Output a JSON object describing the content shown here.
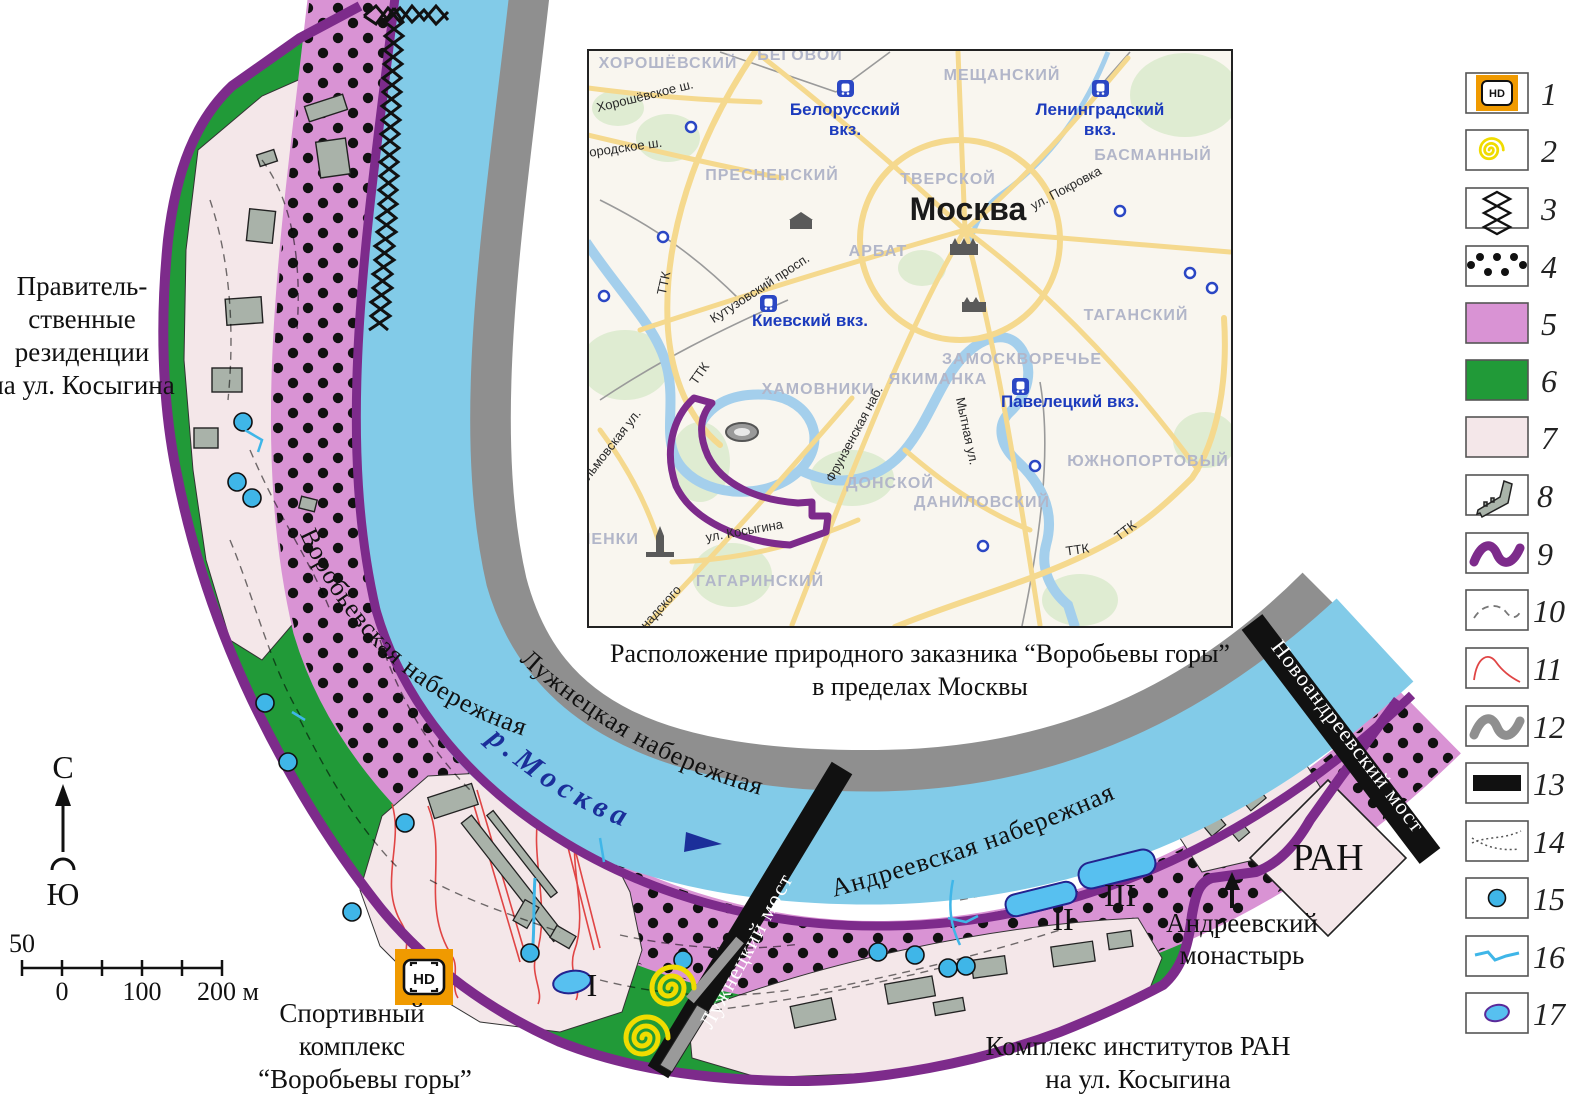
{
  "legend": {
    "numbers": [
      "1",
      "2",
      "3",
      "4",
      "5",
      "6",
      "7",
      "8",
      "9",
      "10",
      "11",
      "12",
      "13",
      "14",
      "15",
      "16",
      "17"
    ],
    "swatches": [
      "hd-marker",
      "spiral",
      "shore-zigzag",
      "dotted-zone",
      "pink-zone",
      "green-zone",
      "lightpink-zone",
      "building",
      "reserve-boundary",
      "dashed-path",
      "red-line",
      "gray-road",
      "bridge",
      "trail",
      "spring",
      "stream",
      "pond"
    ]
  },
  "compass": {
    "north": "С",
    "south": "Ю"
  },
  "scalebar": {
    "above": "50",
    "t0": "0",
    "t100": "100",
    "t200": "200 м"
  },
  "labels": {
    "gov1": "Правитель-",
    "gov2": "ственные",
    "gov3": "резиденции",
    "gov4": "на ул. Косыгина",
    "sport1": "Спортивный",
    "sport2": "комплекс",
    "sport3": "“Воробьевы горы”",
    "ranc1": "Комплекс институтов РАН",
    "ranc2": "на ул. Косыгина",
    "mon1": "Андреевский",
    "mon2": "монастырь",
    "ran": "РАН",
    "num1": "I",
    "num2": "II",
    "num3": "III",
    "hd": "HD",
    "emb_vorob": "Воробьевская набережная",
    "emb_luzh": "Лужнецкая набережная",
    "emb_andr": "Андреевская набережная",
    "river": "р.Москва",
    "bridge1": "Лужнецкий мост",
    "bridge2": "Новоандреевский мост"
  },
  "inset": {
    "caption1": "Расположение природного заказника “Воробьевы горы”",
    "caption2": "в пределах Москвы",
    "city": "Москва",
    "ttk_label": "ТТК",
    "districts": [
      {
        "t": "ХОРОШЁВСКИЙ"
      },
      {
        "t": "БЕГОВОЙ"
      },
      {
        "t": "МЕЩАНСКИЙ"
      },
      {
        "t": "ПРЕСНЕНСКИЙ"
      },
      {
        "t": "ТВЕРСКОЙ"
      },
      {
        "t": "БАСМАННЫЙ"
      },
      {
        "t": "АРБАТ"
      },
      {
        "t": "ТАГАНСКИЙ"
      },
      {
        "t": "ЗАМОСКВОРЕЧЬЕ"
      },
      {
        "t": "ЯКИМАНКА"
      },
      {
        "t": "ХАМОВНИКИ"
      },
      {
        "t": "ДОНСКОЙ"
      },
      {
        "t": "ДАНИЛОВСКИЙ"
      },
      {
        "t": "ЮЖНОПОРТОВЫЙ"
      },
      {
        "t": "ГАГАРИНСКИЙ"
      },
      {
        "t": "МЕНКИ"
      }
    ],
    "streets": [
      {
        "t": "Хорошёвское ш."
      },
      {
        "t": "городское ш."
      },
      {
        "t": "Кутузовский просп."
      },
      {
        "t": "ул. Покровка"
      },
      {
        "t": "Мытная ул."
      },
      {
        "t": "Фрунзенская наб."
      },
      {
        "t": "ильмовская ул."
      },
      {
        "t": "ул. Косыгина"
      },
      {
        "t": "надского"
      }
    ],
    "stations": [
      {
        "l1": "Белорусский",
        "l2": "вкз."
      },
      {
        "l1": "Ленинградский",
        "l2": "вкз."
      },
      {
        "l1": "Киевский вкз.",
        "l2": ""
      },
      {
        "l1": "Павелецкий вкз.",
        "l2": ""
      }
    ]
  },
  "colors": {
    "river": "#82cbe8",
    "graybank": "#8f8f8f",
    "boundary": "#7d2b8b",
    "pink": "#d993d4",
    "green": "#219a38",
    "lightpink": "#f4e7e9",
    "orange": "#f09a00",
    "yellow": "#f0dc00",
    "spring": "#3fb6e8"
  }
}
